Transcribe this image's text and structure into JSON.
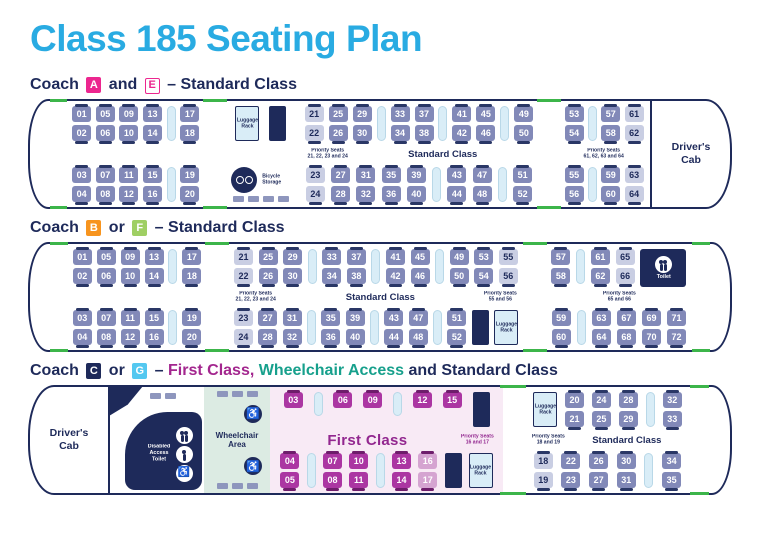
{
  "title": "Class 185 Seating Plan",
  "colors": {
    "title_cyan": "#29abe2",
    "navy": "#1e2a5a",
    "seat": "#8289b8",
    "seat_tab": "#2a3766",
    "priority_seat": "#c9cee3",
    "table": "#d9edf7",
    "first_class_seat": "#ab36a2",
    "first_class_tab": "#6e1d6b",
    "first_class_priority": "#d5a4d1",
    "first_class_bg": "#f8eaf5",
    "first_class_text": "#92278f",
    "wheelchair_bg": "#dcebe3",
    "door_green": "#3cb54a",
    "badge_pink": "#ec268f",
    "badge_orange": "#f7941e",
    "badge_green": "#9fcf63",
    "badge_blue": "#54c8f0",
    "heading_purple": "#a3268e",
    "heading_teal": "#17a08c",
    "slate_block": "#8e96bd"
  },
  "coaches": [
    {
      "id": "ae",
      "heading": [
        {
          "text": "Coach "
        },
        {
          "badge": "A",
          "style": "pink"
        },
        {
          "text": " and "
        },
        {
          "badge": "E",
          "style": "pink-outline"
        },
        {
          "text": " – Standard Class"
        }
      ],
      "segments": [
        {
          "k": "nose",
          "side": "l"
        },
        {
          "k": "seats",
          "top": [
            {
              "t": "p",
              "a": "01",
              "b": "02"
            },
            {
              "t": "p",
              "a": "05",
              "b": "06"
            },
            {
              "t": "p",
              "a": "09",
              "b": "10"
            },
            {
              "t": "p",
              "a": "13",
              "b": "14"
            },
            {
              "t": "tb"
            },
            {
              "t": "p",
              "a": "17",
              "b": "18"
            }
          ],
          "mid": [],
          "bottom": [
            {
              "t": "p",
              "a": "03",
              "b": "04"
            },
            {
              "t": "p",
              "a": "07",
              "b": "08"
            },
            {
              "t": "p",
              "a": "11",
              "b": "12"
            },
            {
              "t": "p",
              "a": "15",
              "b": "16"
            },
            {
              "t": "tb"
            },
            {
              "t": "p",
              "a": "19",
              "b": "20"
            }
          ]
        },
        {
          "k": "door"
        },
        {
          "k": "seats",
          "top": [
            {
              "t": "lg",
              "label": "Luggage Rack"
            },
            {
              "t": "nb"
            }
          ],
          "mid": [],
          "bottom": [
            {
              "t": "bk",
              "label": "Bicycle Storage"
            }
          ]
        },
        {
          "k": "seats",
          "top": [
            {
              "t": "p",
              "a": "21",
              "b": "22",
              "v": "pri"
            },
            {
              "t": "p",
              "a": "25",
              "b": "26"
            },
            {
              "t": "p",
              "a": "29",
              "b": "30"
            },
            {
              "t": "tb"
            },
            {
              "t": "p",
              "a": "33",
              "b": "34"
            },
            {
              "t": "p",
              "a": "37",
              "b": "38"
            },
            {
              "t": "tb"
            },
            {
              "t": "p",
              "a": "41",
              "b": "42"
            },
            {
              "t": "p",
              "a": "45",
              "b": "46"
            },
            {
              "t": "tb"
            },
            {
              "t": "p",
              "a": "49",
              "b": "50"
            }
          ],
          "mid": [
            {
              "t": "pl",
              "lines": [
                "Priority Seats",
                "21, 22, 23 and 24"
              ]
            },
            {
              "t": "cl",
              "text": "Standard Class"
            }
          ],
          "bottom": [
            {
              "t": "p",
              "a": "23",
              "b": "24",
              "v": "pri"
            },
            {
              "t": "p",
              "a": "27",
              "b": "28"
            },
            {
              "t": "p",
              "a": "31",
              "b": "32"
            },
            {
              "t": "p",
              "a": "35",
              "b": "36"
            },
            {
              "t": "p",
              "a": "39",
              "b": "40"
            },
            {
              "t": "tb"
            },
            {
              "t": "p",
              "a": "43",
              "b": "44"
            },
            {
              "t": "p",
              "a": "47",
              "b": "48"
            },
            {
              "t": "tb"
            },
            {
              "t": "p",
              "a": "51",
              "b": "52"
            }
          ]
        },
        {
          "k": "door"
        },
        {
          "k": "seats",
          "top": [
            {
              "t": "p",
              "a": "53",
              "b": "54"
            },
            {
              "t": "tb"
            },
            {
              "t": "p",
              "a": "57",
              "b": "58"
            },
            {
              "t": "p",
              "a": "61",
              "b": "62",
              "v": "pri"
            }
          ],
          "mid": [
            {
              "t": "sp"
            },
            {
              "t": "pl",
              "lines": [
                "Priority Seats",
                "61, 62, 63 and 64"
              ]
            },
            {
              "t": "sp"
            }
          ],
          "bottom": [
            {
              "t": "p",
              "a": "55",
              "b": "56"
            },
            {
              "t": "tb"
            },
            {
              "t": "p",
              "a": "59",
              "b": "60"
            },
            {
              "t": "p",
              "a": "63",
              "b": "64",
              "v": "pri"
            }
          ]
        },
        {
          "k": "cab",
          "label": "Driver's Cab",
          "side": "r"
        }
      ]
    },
    {
      "id": "bf",
      "heading": [
        {
          "text": "Coach "
        },
        {
          "badge": "B",
          "style": "orange"
        },
        {
          "text": " or "
        },
        {
          "badge": "F",
          "style": "green"
        },
        {
          "text": " – Standard Class"
        }
      ],
      "segments": [
        {
          "k": "nose",
          "side": "l"
        },
        {
          "k": "seats",
          "top": [
            {
              "t": "p",
              "a": "01",
              "b": "02"
            },
            {
              "t": "p",
              "a": "05",
              "b": "06"
            },
            {
              "t": "p",
              "a": "09",
              "b": "10"
            },
            {
              "t": "p",
              "a": "13",
              "b": "14"
            },
            {
              "t": "tb"
            },
            {
              "t": "p",
              "a": "17",
              "b": "18"
            }
          ],
          "mid": [],
          "bottom": [
            {
              "t": "p",
              "a": "03",
              "b": "04"
            },
            {
              "t": "p",
              "a": "07",
              "b": "08"
            },
            {
              "t": "p",
              "a": "11",
              "b": "12"
            },
            {
              "t": "p",
              "a": "15",
              "b": "16"
            },
            {
              "t": "tb"
            },
            {
              "t": "p",
              "a": "19",
              "b": "20"
            }
          ]
        },
        {
          "k": "door"
        },
        {
          "k": "seats",
          "top": [
            {
              "t": "p",
              "a": "21",
              "b": "22",
              "v": "pri"
            },
            {
              "t": "p",
              "a": "25",
              "b": "26"
            },
            {
              "t": "p",
              "a": "29",
              "b": "30"
            },
            {
              "t": "tb"
            },
            {
              "t": "p",
              "a": "33",
              "b": "34"
            },
            {
              "t": "p",
              "a": "37",
              "b": "38"
            },
            {
              "t": "tb"
            },
            {
              "t": "p",
              "a": "41",
              "b": "42"
            },
            {
              "t": "p",
              "a": "45",
              "b": "46"
            },
            {
              "t": "tb"
            },
            {
              "t": "p",
              "a": "49",
              "b": "50"
            },
            {
              "t": "p",
              "a": "53",
              "b": "54"
            },
            {
              "t": "p",
              "a": "55",
              "b": "56",
              "v": "pri"
            }
          ],
          "mid": [
            {
              "t": "pl",
              "lines": [
                "Priority Seats",
                "21, 22, 23 and 24"
              ]
            },
            {
              "t": "cl",
              "text": "Standard Class"
            },
            {
              "t": "pl",
              "lines": [
                "Priority Seats",
                "55 and 56"
              ]
            }
          ],
          "bottom": [
            {
              "t": "p",
              "a": "23",
              "b": "24",
              "v": "pri"
            },
            {
              "t": "p",
              "a": "27",
              "b": "28"
            },
            {
              "t": "p",
              "a": "31",
              "b": "32"
            },
            {
              "t": "tb"
            },
            {
              "t": "p",
              "a": "35",
              "b": "36"
            },
            {
              "t": "p",
              "a": "39",
              "b": "40"
            },
            {
              "t": "tb"
            },
            {
              "t": "p",
              "a": "43",
              "b": "44"
            },
            {
              "t": "p",
              "a": "47",
              "b": "48"
            },
            {
              "t": "tb"
            },
            {
              "t": "p",
              "a": "51",
              "b": "52"
            },
            {
              "t": "nb"
            },
            {
              "t": "lg",
              "label": "Luggage Rack"
            }
          ]
        },
        {
          "k": "door"
        },
        {
          "k": "seats",
          "top": [
            {
              "t": "p",
              "a": "57",
              "b": "58"
            },
            {
              "t": "tb"
            },
            {
              "t": "p",
              "a": "61",
              "b": "62"
            },
            {
              "t": "p",
              "a": "65",
              "b": "66",
              "v": "pri"
            },
            {
              "t": "tl",
              "label": "Toilet"
            }
          ],
          "mid": [
            {
              "t": "sp"
            },
            {
              "t": "pl",
              "lines": [
                "Priority Seats",
                "65 and 66"
              ]
            },
            {
              "t": "sp"
            }
          ],
          "bottom": [
            {
              "t": "p",
              "a": "59",
              "b": "60"
            },
            {
              "t": "tb"
            },
            {
              "t": "p",
              "a": "63",
              "b": "64"
            },
            {
              "t": "p",
              "a": "67",
              "b": "68"
            },
            {
              "t": "p",
              "a": "69",
              "b": "70"
            },
            {
              "t": "p",
              "a": "71",
              "b": "72"
            }
          ]
        },
        {
          "k": "nose",
          "side": "r"
        }
      ]
    },
    {
      "id": "cg",
      "heading": [
        {
          "text": "Coach "
        },
        {
          "badge": "C",
          "style": "navy"
        },
        {
          "text": " or "
        },
        {
          "badge": "G",
          "style": "blue"
        },
        {
          "text": " – "
        },
        {
          "text": "First Class,",
          "color": "purple"
        },
        {
          "text": " "
        },
        {
          "text": "Wheelchair Access",
          "color": "teal"
        },
        {
          "text": " and Standard Class"
        }
      ],
      "segments": [
        {
          "k": "cab",
          "label": "Driver's Cab",
          "side": "l"
        },
        {
          "k": "dtoilet",
          "label": "Disabled Access Toilet"
        },
        {
          "k": "wheelchair",
          "label": "Wheelchair Area"
        },
        {
          "k": "seats",
          "fc": true,
          "top": [
            {
              "t": "s",
              "a": "03",
              "v": "fc"
            },
            {
              "t": "tb"
            },
            {
              "t": "s",
              "a": "06",
              "v": "fc"
            },
            {
              "t": "s",
              "a": "09",
              "v": "fc"
            },
            {
              "t": "tb"
            },
            {
              "t": "s",
              "a": "12",
              "v": "fc"
            },
            {
              "t": "s",
              "a": "15",
              "v": "fc"
            },
            {
              "t": "nb"
            }
          ],
          "mid": [
            {
              "t": "fl",
              "text": "First Class"
            },
            {
              "t": "pl",
              "lines": [
                "Priority Seats",
                "16 and 17"
              ]
            }
          ],
          "bottom": [
            {
              "t": "p",
              "a": "04",
              "b": "05",
              "v": "fc"
            },
            {
              "t": "tb",
              "tall": true
            },
            {
              "t": "p",
              "a": "07",
              "b": "08",
              "v": "fc"
            },
            {
              "t": "p",
              "a": "10",
              "b": "11",
              "v": "fc"
            },
            {
              "t": "tb",
              "tall": true
            },
            {
              "t": "p",
              "a": "13",
              "b": "14",
              "v": "fc"
            },
            {
              "t": "p",
              "a": "16",
              "b": "17",
              "v": "fcp"
            },
            {
              "t": "nb"
            },
            {
              "t": "lg",
              "label": "Luggage Rack"
            }
          ]
        },
        {
          "k": "door"
        },
        {
          "k": "seats",
          "top": [
            {
              "t": "lg",
              "label": "Luggage Rack"
            },
            {
              "t": "p",
              "a": "20",
              "b": "21"
            },
            {
              "t": "p",
              "a": "24",
              "b": "25"
            },
            {
              "t": "p",
              "a": "28",
              "b": "29"
            },
            {
              "t": "tb"
            },
            {
              "t": "p",
              "a": "32",
              "b": "33"
            }
          ],
          "mid": [
            {
              "t": "pl",
              "lines": [
                "Priority Seats",
                "18 and 19"
              ]
            },
            {
              "t": "cl",
              "text": "Standard Class"
            }
          ],
          "bottom": [
            {
              "t": "p",
              "a": "18",
              "b": "19",
              "v": "pri"
            },
            {
              "t": "p",
              "a": "22",
              "b": "23"
            },
            {
              "t": "p",
              "a": "26",
              "b": "27"
            },
            {
              "t": "p",
              "a": "30",
              "b": "31"
            },
            {
              "t": "tb"
            },
            {
              "t": "p",
              "a": "34",
              "b": "35"
            }
          ]
        },
        {
          "k": "nose",
          "side": "r"
        }
      ]
    }
  ]
}
